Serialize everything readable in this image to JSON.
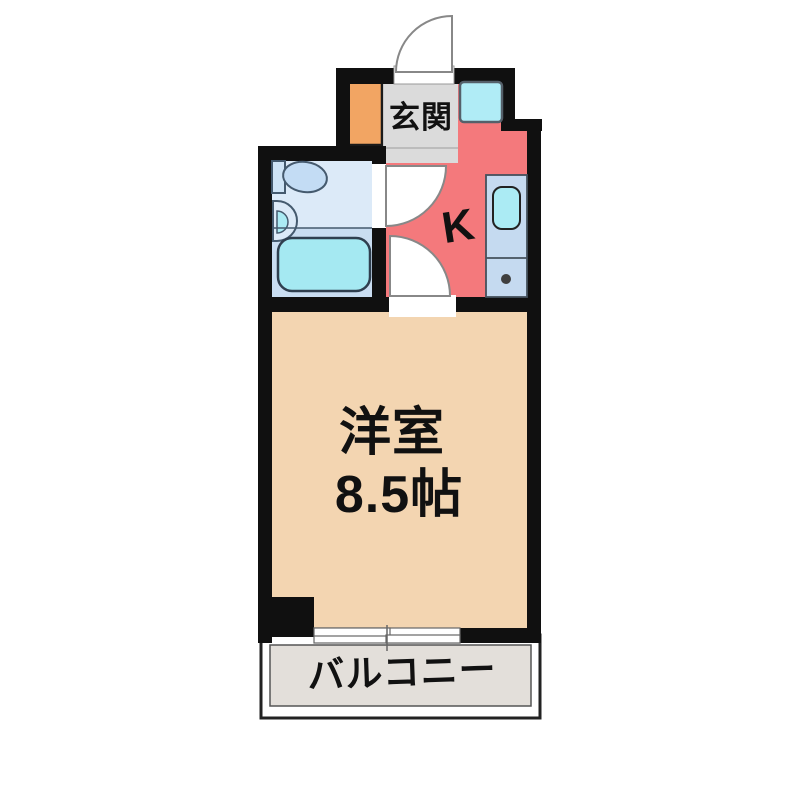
{
  "figure": {
    "type": "floor-plan",
    "description": "Japanese 1K apartment floor plan with entrance, kitchen, unit bath, western room and balcony"
  },
  "labels": {
    "entrance": "玄関",
    "kitchen": "K",
    "main_room_name": "洋室",
    "main_room_size": "8.5帖",
    "balcony": "バルコニー"
  },
  "colors": {
    "wall": "#101010",
    "kitchen": "#F4797C",
    "main_room": "#F3D5B1",
    "entrance_floor": "#DBDBDB",
    "shoe_cabinet": "#F2A563",
    "bathroom_upper": "#DCEAF8",
    "bathroom_lower": "#C9DDF1",
    "bathtub": "#A5E9F2",
    "counter": "#C5DAF0",
    "counter_sink": "#ABEBF4",
    "washer_space": "#B0ECF6",
    "balcony": "#E3DFDA",
    "door_arc_stroke": "#888888"
  },
  "fixtures": [
    "entrance-door",
    "washing-machine-space",
    "shoe-cabinet",
    "toilet",
    "wash-basin",
    "bathtub",
    "kitchen-counter",
    "kitchen-sink",
    "stove-burner",
    "sliding-window",
    "pillar"
  ]
}
